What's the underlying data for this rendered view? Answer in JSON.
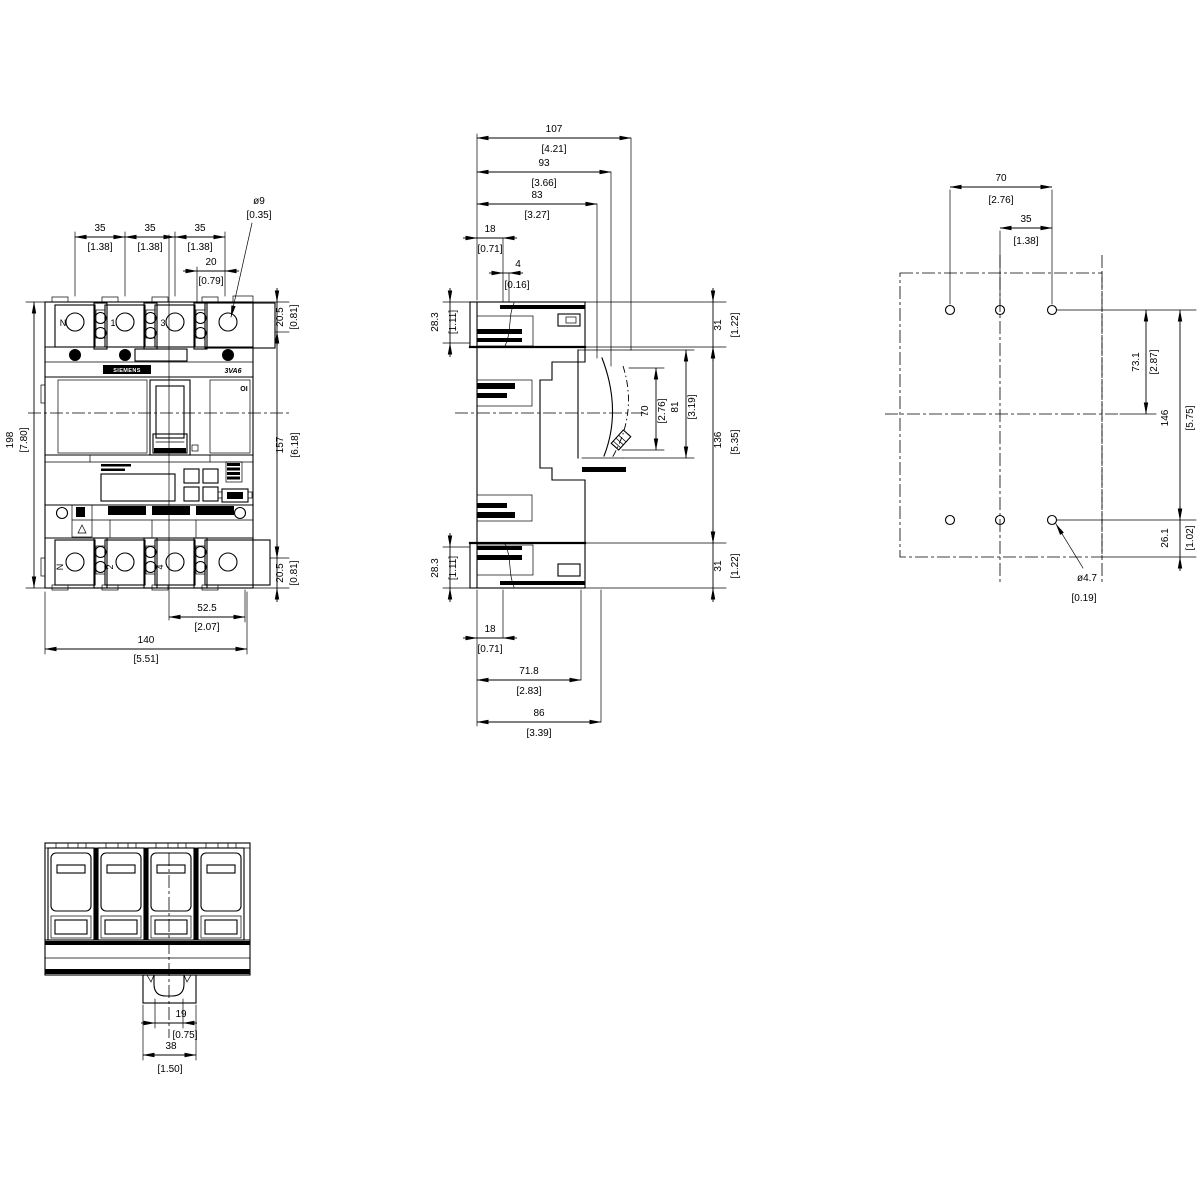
{
  "front": {
    "labels": {
      "brand": "SIEMENS",
      "model": "3VA6",
      "on_off": "OI",
      "pole_n_top": "N",
      "pole_1": "1",
      "pole_3": "3",
      "pole_n_bottom": "N",
      "pole_2": "2",
      "pole_4": "4"
    },
    "dims": {
      "pitch1": {
        "mm": "35",
        "inch": "[1.38]"
      },
      "pitch2": {
        "mm": "35",
        "inch": "[1.38]"
      },
      "pitch3": {
        "mm": "35",
        "inch": "[1.38]"
      },
      "hole_offset": {
        "mm": "20",
        "inch": "[0.79]"
      },
      "hole_dia": {
        "mm": "ø9",
        "inch": "[0.35]"
      },
      "top_margin": {
        "mm": "20.5",
        "inch": "[0.81]"
      },
      "inner_height": {
        "mm": "157",
        "inch": "[6.18]"
      },
      "bottom_margin": {
        "mm": "20.5",
        "inch": "[0.81]"
      },
      "total_height": {
        "mm": "198",
        "inch": "[7.80]"
      },
      "center_to_right": {
        "mm": "52.5",
        "inch": "[2.07]"
      },
      "total_width": {
        "mm": "140",
        "inch": "[5.51]"
      }
    }
  },
  "side": {
    "dims": {
      "depth_107": {
        "mm": "107",
        "inch": "[4.21]"
      },
      "depth_93": {
        "mm": "93",
        "inch": "[3.66]"
      },
      "depth_83": {
        "mm": "83",
        "inch": "[3.27]"
      },
      "top_18": {
        "mm": "18",
        "inch": "[0.71]"
      },
      "top_4": {
        "mm": "4",
        "inch": "[0.16]"
      },
      "top_28_3": {
        "mm": "28.3",
        "inch": "[1.11]"
      },
      "bottom_28_3": {
        "mm": "28.3",
        "inch": "[1.11]"
      },
      "top_31": {
        "mm": "31",
        "inch": "[1.22]"
      },
      "bottom_31": {
        "mm": "31",
        "inch": "[1.22]"
      },
      "mid_136": {
        "mm": "136",
        "inch": "[5.35]"
      },
      "handle_70": {
        "mm": "70",
        "inch": "[2.76]"
      },
      "handle_81": {
        "mm": "81",
        "inch": "[3.19]"
      },
      "bottom_18": {
        "mm": "18",
        "inch": "[0.71]"
      },
      "bottom_71_8": {
        "mm": "71.8",
        "inch": "[2.83]"
      },
      "bottom_86": {
        "mm": "86",
        "inch": "[3.39]"
      }
    }
  },
  "drilling": {
    "dims": {
      "h_70": {
        "mm": "70",
        "inch": "[2.76]"
      },
      "h_35": {
        "mm": "35",
        "inch": "[1.38]"
      },
      "v_73_1": {
        "mm": "73.1",
        "inch": "[2.87]"
      },
      "v_146": {
        "mm": "146",
        "inch": "[5.75]"
      },
      "v_26_1": {
        "mm": "26.1",
        "inch": "[1.02]"
      },
      "hole_dia": {
        "mm": "ø4.7",
        "inch": "[0.19]"
      }
    }
  },
  "bottom": {
    "dims": {
      "clip_slot": {
        "mm": "19",
        "inch": "[0.75]"
      },
      "clip_width": {
        "mm": "38",
        "inch": "[1.50]"
      }
    }
  }
}
